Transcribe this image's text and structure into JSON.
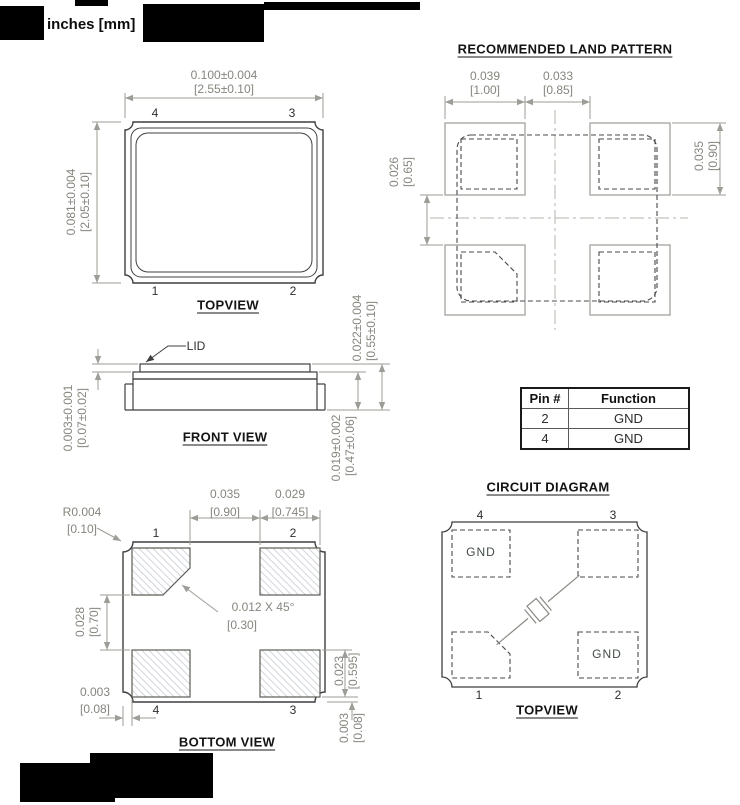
{
  "colors": {
    "dimension_text": "#84877e",
    "dimension_line": "#9b9e96",
    "part_outline": "#3f3f3f",
    "title_text": "#141414",
    "hatch": "#c4c8cf",
    "redaction": "#000000"
  },
  "header": {
    "units_label": "inches [mm]"
  },
  "top_view": {
    "title": "TOPVIEW",
    "dim_w_in": "0.100±0.004",
    "dim_w_mm": "[2.55±0.10]",
    "dim_h_in": "0.081±0.004",
    "dim_h_mm": "[2.05±0.10]",
    "pins": {
      "tl": "4",
      "tr": "3",
      "bl": "1",
      "br": "2"
    }
  },
  "land_pattern": {
    "title": "RECOMMENDED LAND PATTERN",
    "pad_w_in": "0.039",
    "pad_w_mm": "[1.00]",
    "gap_in": "0.033",
    "gap_mm": "[0.85]",
    "vgap_in": "0.026",
    "vgap_mm": "[0.65]",
    "pad_h_in": "0.035",
    "pad_h_mm": "[0.90]"
  },
  "front_view": {
    "title": "FRONT VIEW",
    "lid_label": "LID",
    "lid_in": "0.003±0.001",
    "lid_mm": "[0.07±0.02]",
    "total_in": "0.022±0.004",
    "total_mm": "[0.55±0.10]",
    "body_in": "0.019±0.002",
    "body_mm": "[0.47±0.06]"
  },
  "pin_table": {
    "headers": [
      "Pin #",
      "Function"
    ],
    "rows": [
      [
        "2",
        "GND"
      ],
      [
        "4",
        "GND"
      ]
    ]
  },
  "bottom_view": {
    "title": "BOTTOM VIEW",
    "radius_in": "R0.004",
    "radius_mm": "[0.10]",
    "gap_in": "0.035",
    "gap_mm": "[0.90]",
    "pad_w_in": "0.029",
    "pad_w_mm": "[0.745]",
    "chamfer_in": "0.012 X 45°",
    "chamfer_mm": "[0.30]",
    "vgap_in": "0.028",
    "vgap_mm": "[0.70]",
    "edge_bl_in": "0.003",
    "edge_bl_mm": "[0.08]",
    "pad_h_in": "0.023",
    "pad_h_mm": "[0.595]",
    "edge_br_in": "0.003",
    "edge_br_mm": "[0.08]",
    "pins": {
      "tl": "1",
      "tr": "2",
      "bl": "4",
      "br": "3"
    }
  },
  "circuit": {
    "title": "CIRCUIT DIAGRAM",
    "subtitle": "TOPVIEW",
    "gnd_tl": "GND",
    "gnd_br": "GND",
    "pins": {
      "tl": "4",
      "tr": "3",
      "bl": "1",
      "br": "2"
    }
  }
}
